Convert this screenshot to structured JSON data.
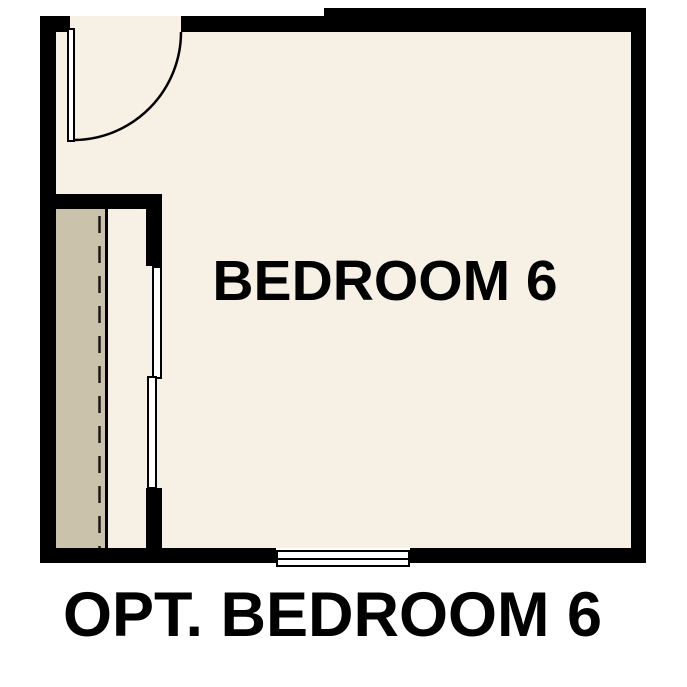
{
  "floorplan": {
    "room_label": "BEDROOM 6",
    "caption": "OPT. BEDROOM 6",
    "colors": {
      "wall": "#000000",
      "floor": "#f7f0e4",
      "closet_shelf": "#cbc2ab",
      "line": "#1a1a1a",
      "text": "#000000",
      "background": "#ffffff"
    },
    "symbols": {
      "entry_door": "door-leaf-with-swing-arc",
      "closet": "closet-shelf-with-dashed-rod-and-bypass-doors",
      "window": "double-line-window"
    }
  }
}
